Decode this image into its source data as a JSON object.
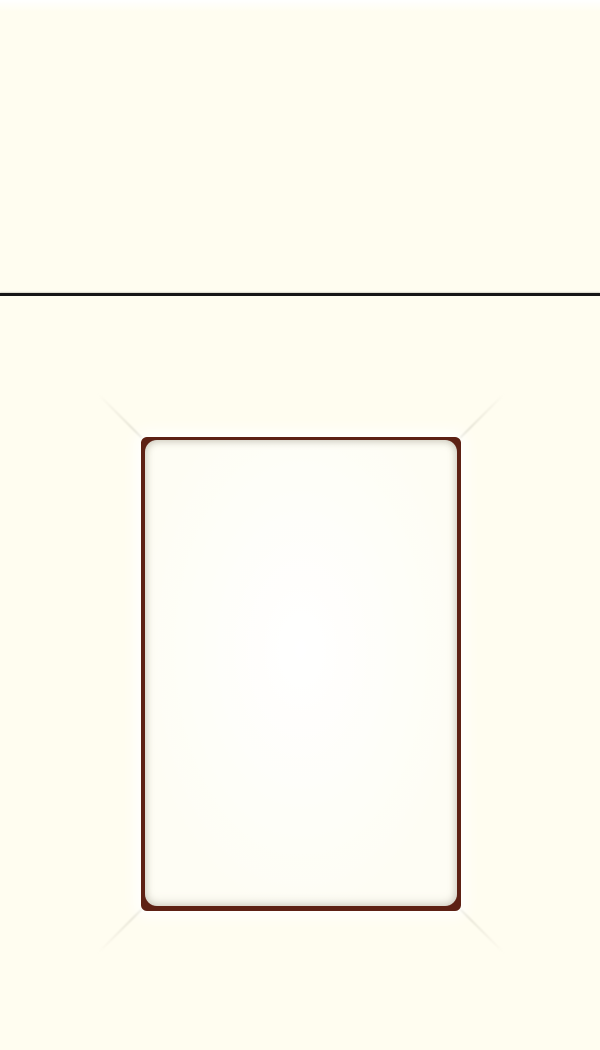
{
  "scene": {
    "subject": "cabinet-door-and-drawer-front-sample",
    "text_content": "none"
  },
  "colors": {
    "background": "#fffdf0",
    "highlight": "#ffffff",
    "divider_line": "#161616",
    "panel_border": "#5d2114",
    "panel_fill": "#fefdf4",
    "miter_shadow": "#cfccbd"
  }
}
